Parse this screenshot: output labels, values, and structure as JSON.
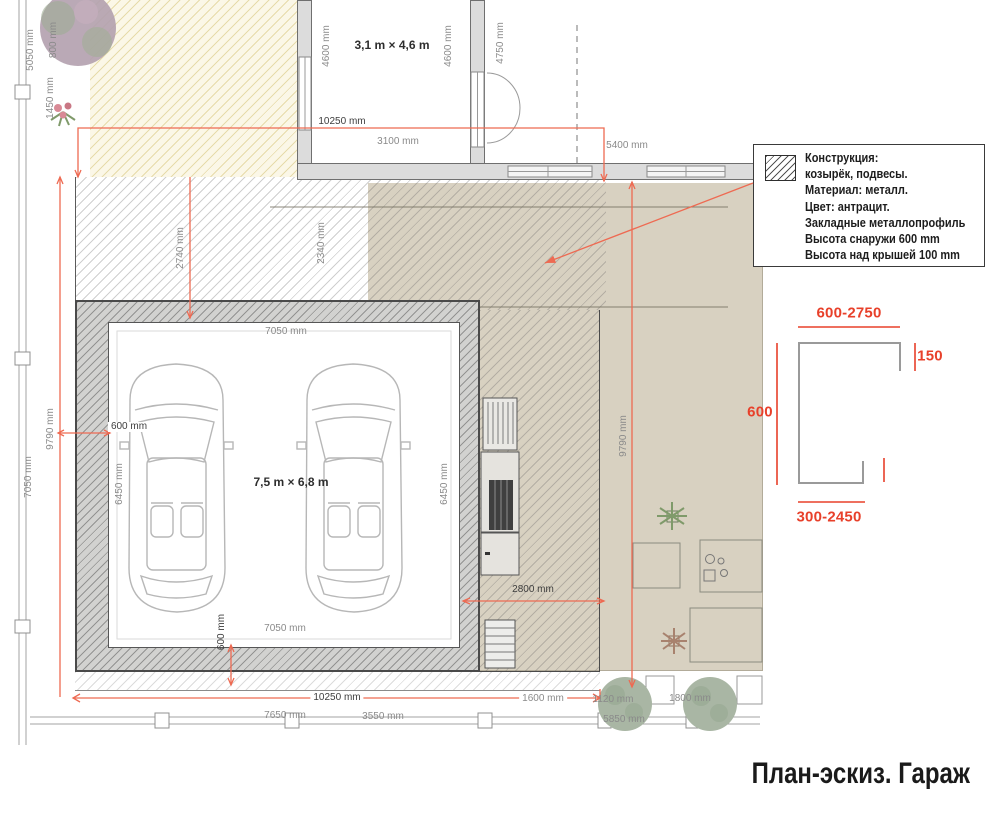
{
  "title": "План-эскиз. Гараж",
  "legend": {
    "lines": [
      "Конструкция:",
      "козырёк, подвесы.",
      "Материал: металл.",
      "Цвет: антрацит.",
      "Закладные металлопрофиль",
      "Высота снаружи 600 mm",
      "Высота над крышей 100 mm"
    ]
  },
  "rooms": {
    "top_room": "3,1 m × 4,6 m",
    "garage": "7,5 m × 6,8 m"
  },
  "plan_dims": {
    "l5050": "5050 mm",
    "l800": "800 mm",
    "l1450": "1450 mm",
    "t4600a": "4600 mm",
    "t4600b": "4600 mm",
    "t4750": "4750 mm",
    "t10250": "10250 mm",
    "t3100": "3100 mm",
    "t5400": "5400 mm",
    "m2740": "2740 mm",
    "m2340": "2340 mm",
    "l9790": "9790 mm",
    "l7050": "7050 mm",
    "r9790": "9790 mm",
    "g7050t": "7050 mm",
    "g600l": "600 mm",
    "g6450l": "6450 mm",
    "g6450r": "6450 mm",
    "g7050b": "7050 mm",
    "g600b": "600 mm",
    "r2800": "2800 mm",
    "b10250": "10250 mm",
    "b1600": "1600 mm",
    "b1120": "1120 mm",
    "b1800": "1800 mm",
    "b7650": "7650 mm",
    "b3550": "3550 mm",
    "b5850": "5850 mm"
  },
  "detail_dims": {
    "top": "600-2750",
    "right": "150",
    "left": "600",
    "bottom": "300-2450"
  },
  "colors": {
    "dim_red": "#ee6a52",
    "detail_red": "#e8402a",
    "text_dark": "#3d3d3d",
    "text_gray": "#8a8a8a",
    "wall_gray": "#dcdcdc",
    "terrace_beige": "#d8d1c1",
    "yard_yellow": "#fbf7e7",
    "tree_green": "#a9b6a4",
    "bush_pink": "#b3a0ae"
  }
}
